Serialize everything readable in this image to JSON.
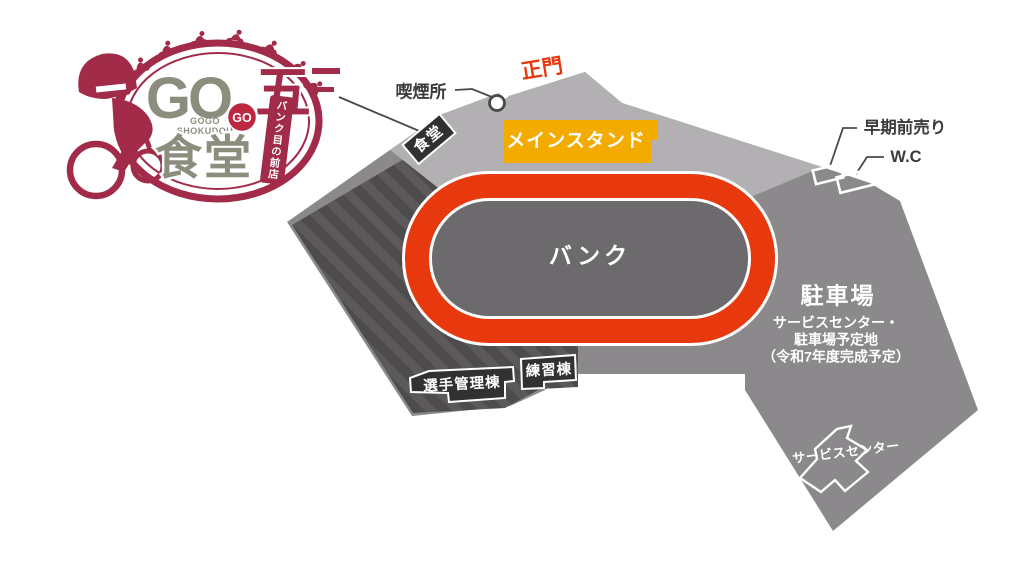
{
  "logo": {
    "go_main": "GO",
    "five": "五",
    "go_badge": "GO",
    "subtitle_line1": "GOGO",
    "subtitle_line2": "SHOKUDOU",
    "shokudo": "食堂",
    "banner_vertical": "バンク目の前店"
  },
  "map": {
    "labels": {
      "smoking_area": "喫煙所",
      "main_gate": "正門",
      "main_stand": "メインスタンド",
      "cafeteria": "食堂",
      "bank": "バンク",
      "early_ticket": "早期前売り",
      "wc": "W.C",
      "parking": "駐車場",
      "parking_note_line1": "サービスセンター・",
      "parking_note_line2": "駐車場予定地",
      "parking_note_line3": "（令和7年度完成予定）",
      "athlete_building": "選手管理棟",
      "practice_building": "練習棟",
      "service_center": "サービスセンター"
    }
  },
  "colors": {
    "maroon": "#a12b49",
    "olive": "#8d8d7e",
    "badge_red": "#bc2742",
    "light_gray": "#b2b0b2",
    "medium_gray": "#8b898b",
    "stripe_base": "#4d4b4b",
    "stripe_light": "#5b5959",
    "track_red": "#e8380d",
    "infield_gray": "#6c6a6c",
    "stand_yellow": "#f4ab00",
    "label_dark": "#3c3a3a",
    "tag_dark": "#333031"
  }
}
